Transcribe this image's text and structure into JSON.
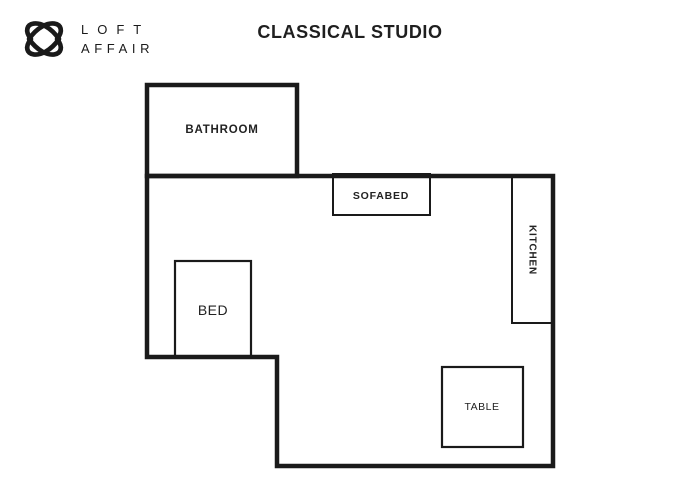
{
  "brand": {
    "line1": "LOFT",
    "line2": "AFFAIR",
    "icon": "interlocked-hearts-knot-icon"
  },
  "title": "CLASSICAL STUDIO",
  "floorplan": {
    "bathroom": {
      "label": "BATHROOM"
    },
    "main_room": {
      "sofabed": {
        "label": "SOFABED"
      },
      "kitchen": {
        "label": "KITCHEN"
      },
      "bed": {
        "label": "BED"
      },
      "table": {
        "label": "TABLE"
      }
    }
  },
  "colors": {
    "wall": "#1a1a1a",
    "furniture_line": "#1a1a1a",
    "label_text": "#222222",
    "background": "#ffffff",
    "brand_text": "#1a1a1a"
  }
}
